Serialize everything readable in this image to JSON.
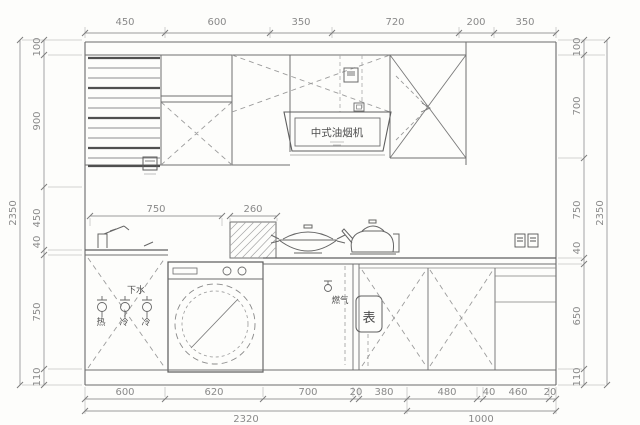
{
  "dims": {
    "top": [
      "450",
      "600",
      "350",
      "720",
      "200",
      "350"
    ],
    "left": [
      "100",
      "900",
      "450",
      "40",
      "750",
      "110"
    ],
    "left_total": "2350",
    "right": [
      "100",
      "700",
      "750",
      "40",
      "650",
      "110"
    ],
    "right_total": "2350",
    "mid": [
      "750",
      "260"
    ],
    "bottom": [
      "600",
      "620",
      "700",
      "20",
      "380",
      "480",
      "40",
      "460",
      "20"
    ],
    "bottom_totals": [
      "2320",
      "1000"
    ]
  },
  "labels": {
    "range_hood": "中式油烟机",
    "drain": "下水",
    "valve_labels": [
      "热",
      "冷",
      "冷"
    ],
    "gas": "燃气",
    "meter": "表"
  },
  "colors": {
    "line": "#6b6b6b",
    "dim_line": "#9b9b9b",
    "dim_text": "#8a8a8a",
    "dashed": "#9c9c9c",
    "background": "#fdfdfb"
  }
}
